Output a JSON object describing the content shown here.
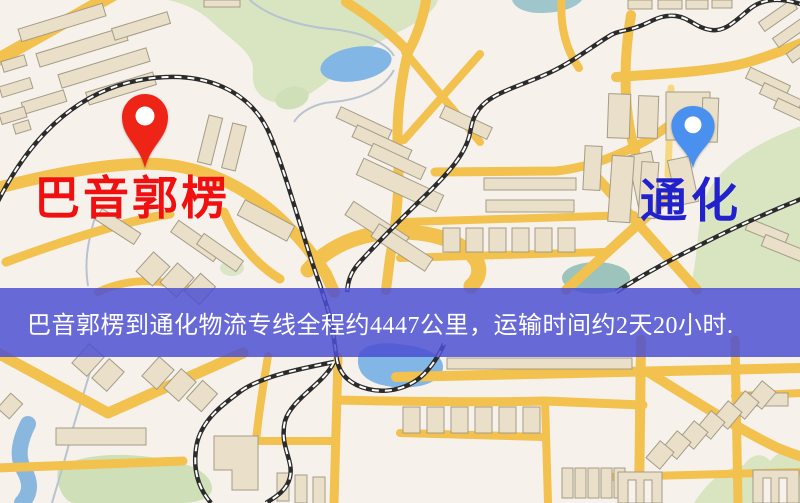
{
  "page": {
    "kind": "logistics-route-map-image",
    "width_px": 800,
    "height_px": 503
  },
  "route": {
    "origin": "巴音郭楞",
    "destination": "通化",
    "distance_text": "约4447公里",
    "duration_text": "约2天20小时"
  },
  "banner": {
    "text": "巴音郭楞到通化物流专线全程约4447公里，运输时间约2天20小时.",
    "bg_color": "#4b4fd2",
    "text_color": "#ffffff"
  },
  "markers": {
    "origin": {
      "label": "巴音郭楞",
      "label_color": "#f01010",
      "pin_color": "#ee2417"
    },
    "destination": {
      "label": "通化",
      "label_color": "#2222cc",
      "pin_color": "#4a90ee"
    }
  },
  "map_colors": {
    "background": "#f7f1ec",
    "road": "#f2c14e",
    "road_minor": "#f6d883",
    "building_fill": "#eadfc8",
    "building_stroke": "#a39c86",
    "park_green": "#d8e5c0",
    "water_blue": "#82b6e4",
    "stream_grey": "#b7c3ce",
    "railway_dark": "#2b2b2b"
  }
}
